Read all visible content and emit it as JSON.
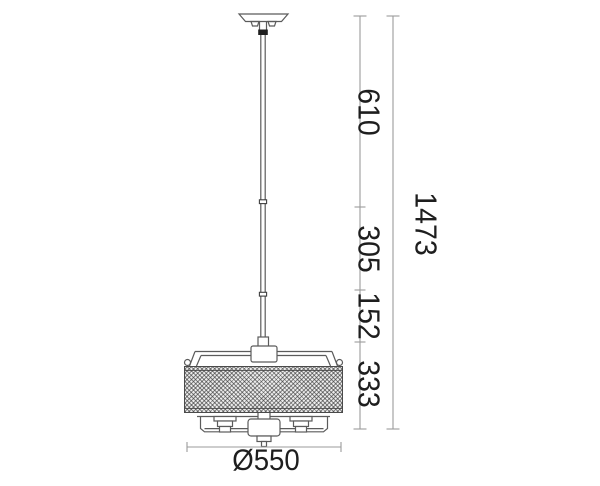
{
  "diagram": {
    "kind": "pendant-lamp dimension drawing",
    "dimensions": {
      "segments": [
        {
          "id": "rod-upper",
          "label": "610",
          "value_mm": 610
        },
        {
          "id": "rod-middle",
          "label": "305",
          "value_mm": 305
        },
        {
          "id": "rod-lower",
          "label": "152",
          "value_mm": 152
        },
        {
          "id": "body-height",
          "label": "333",
          "value_mm": 333
        }
      ],
      "total_height": {
        "label": "1473",
        "value_mm": 1473
      },
      "diameter": {
        "label": "Ø550",
        "value_mm": 550
      }
    },
    "colors": {
      "background": "#ffffff",
      "fixture_outline": "#5b5b5b",
      "dimension_lines": "#9b9b9b",
      "dimension_text": "#1e1e1e",
      "shade_fill": "#ececec",
      "collar_fill": "#1f1f1f"
    }
  }
}
